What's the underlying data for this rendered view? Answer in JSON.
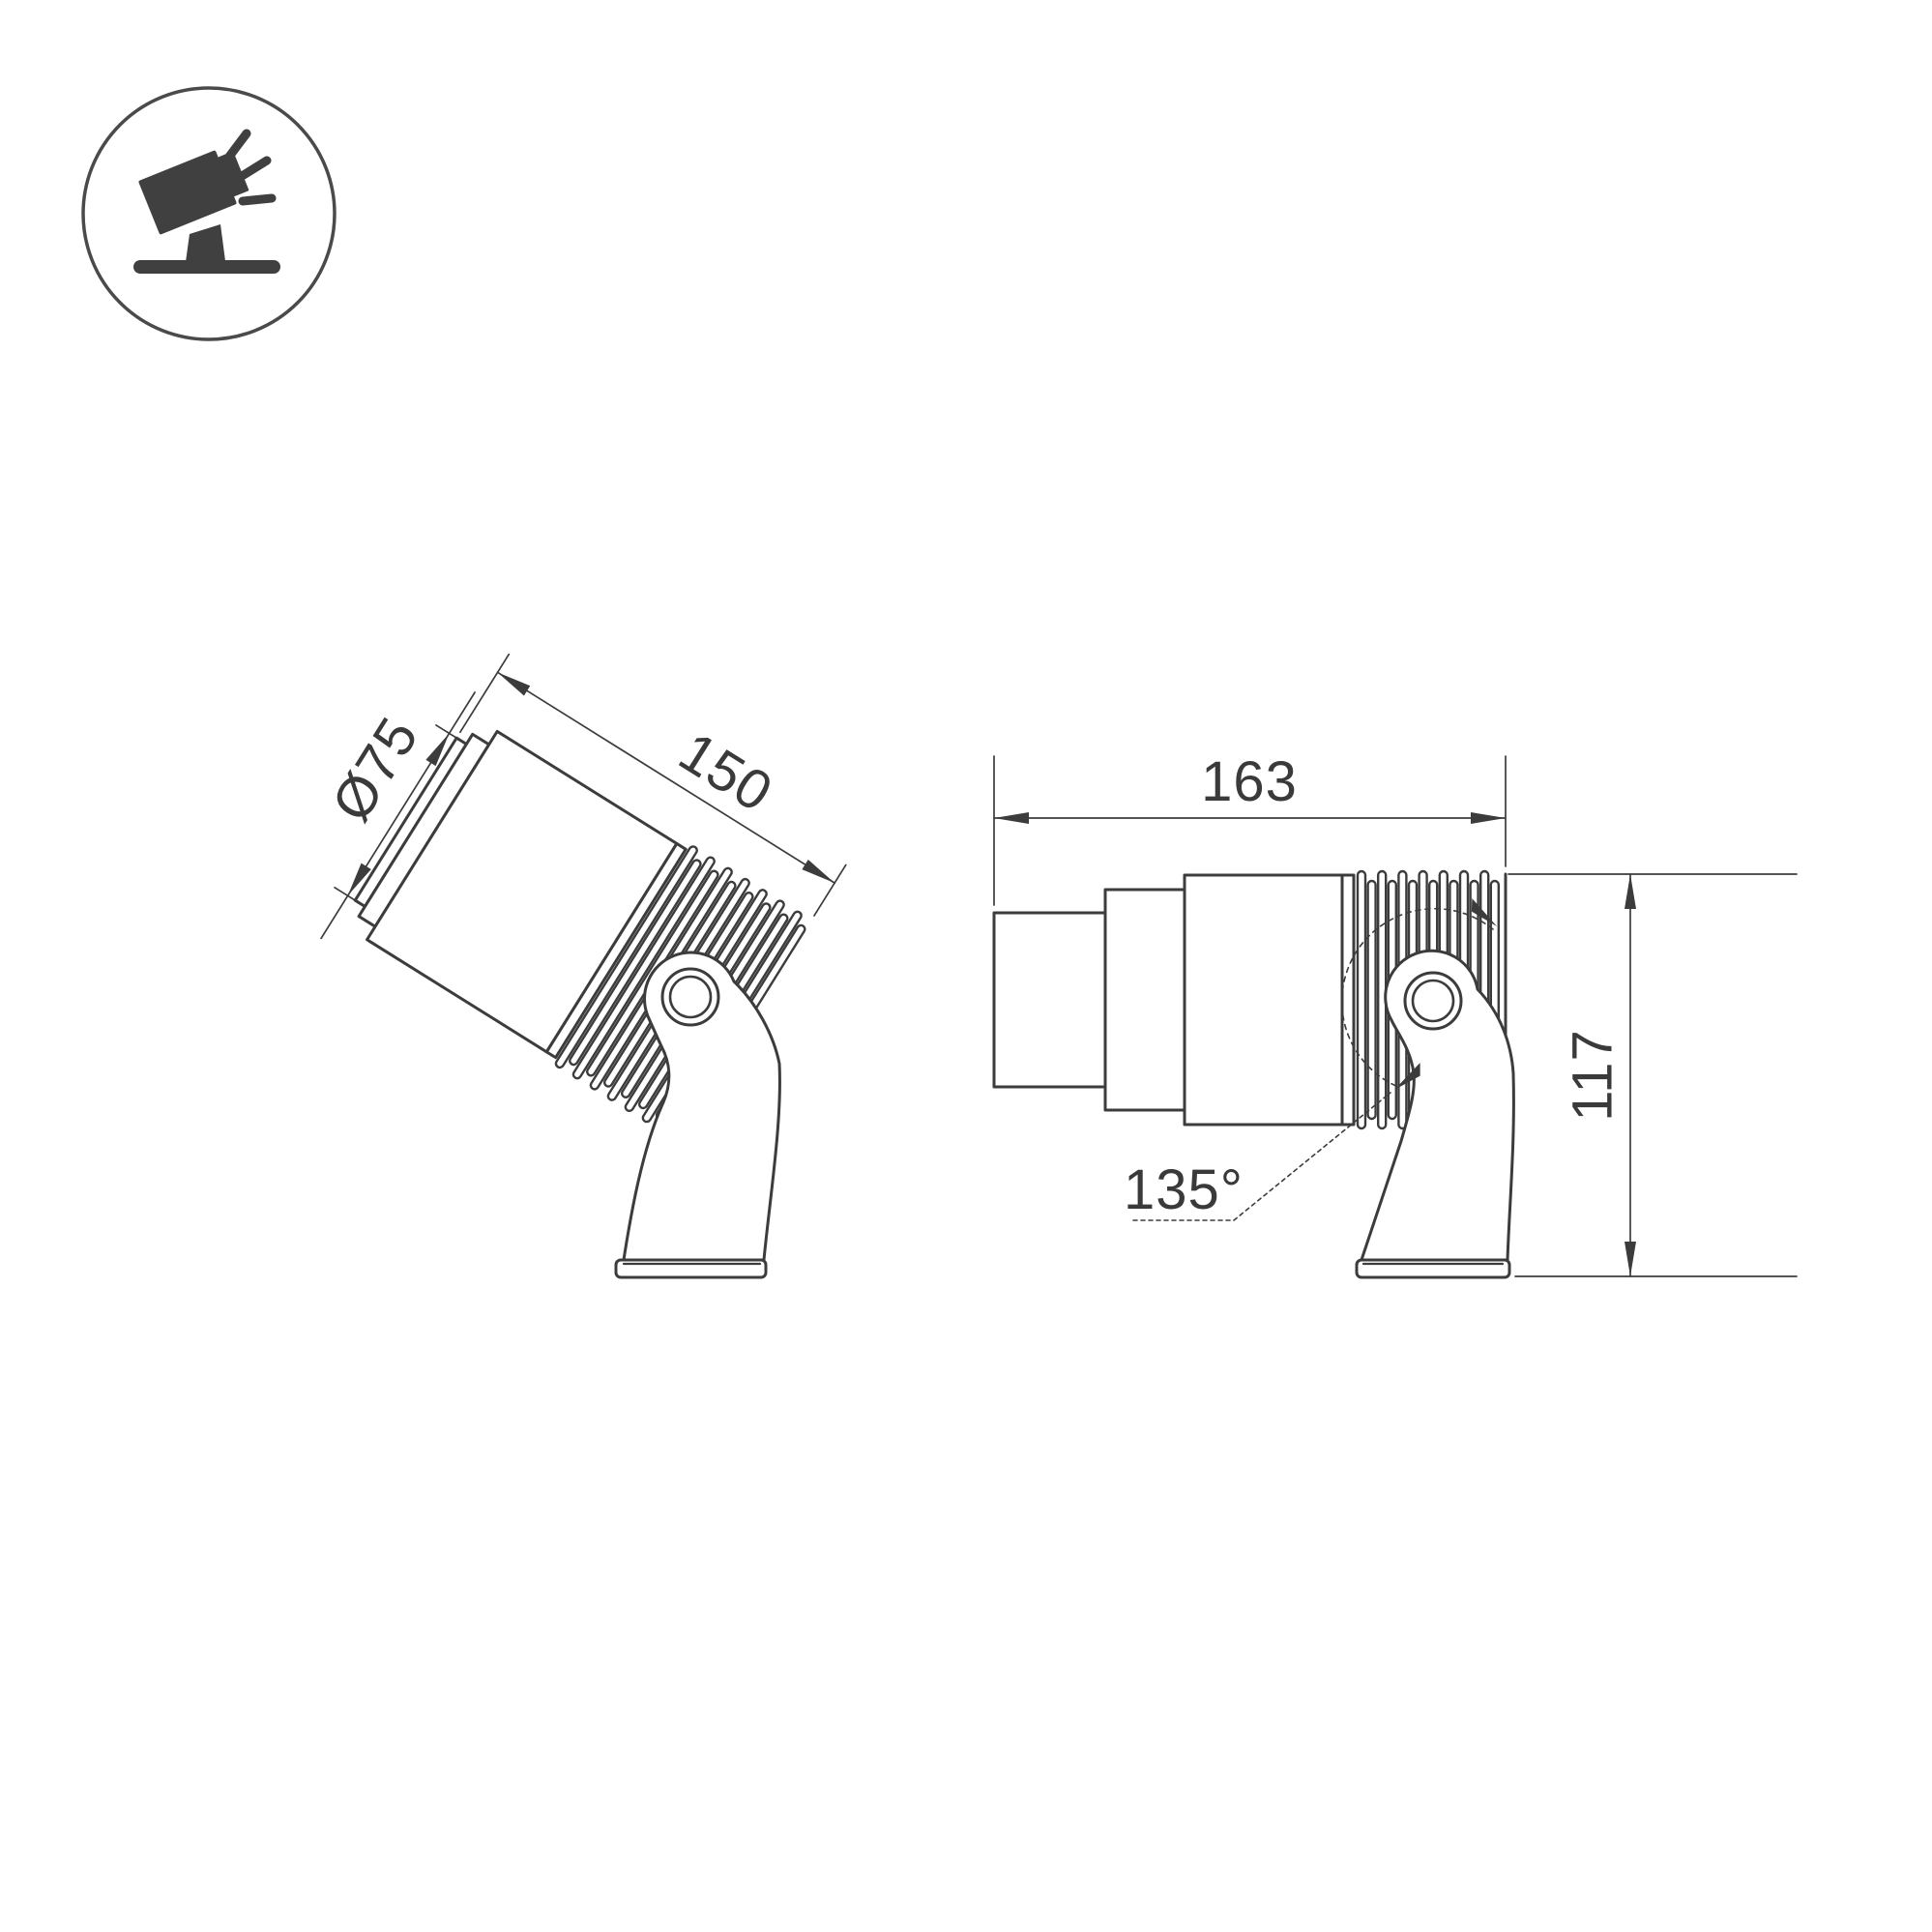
{
  "meta": {
    "background": "#ffffff",
    "line_color": "#3c3c3c",
    "text_color": "#3a3a3a",
    "icon_color": "#404040",
    "drawing_type": "spotlight-luminaire-dimension-drawing"
  },
  "icon": {
    "name": "tilted-spotlight-on-stand-icon"
  },
  "left_view": {
    "diameter_label": "Ø75",
    "length_label": "150"
  },
  "right_view": {
    "width_label": "163",
    "height_label": "117",
    "angle_label": "135°"
  }
}
